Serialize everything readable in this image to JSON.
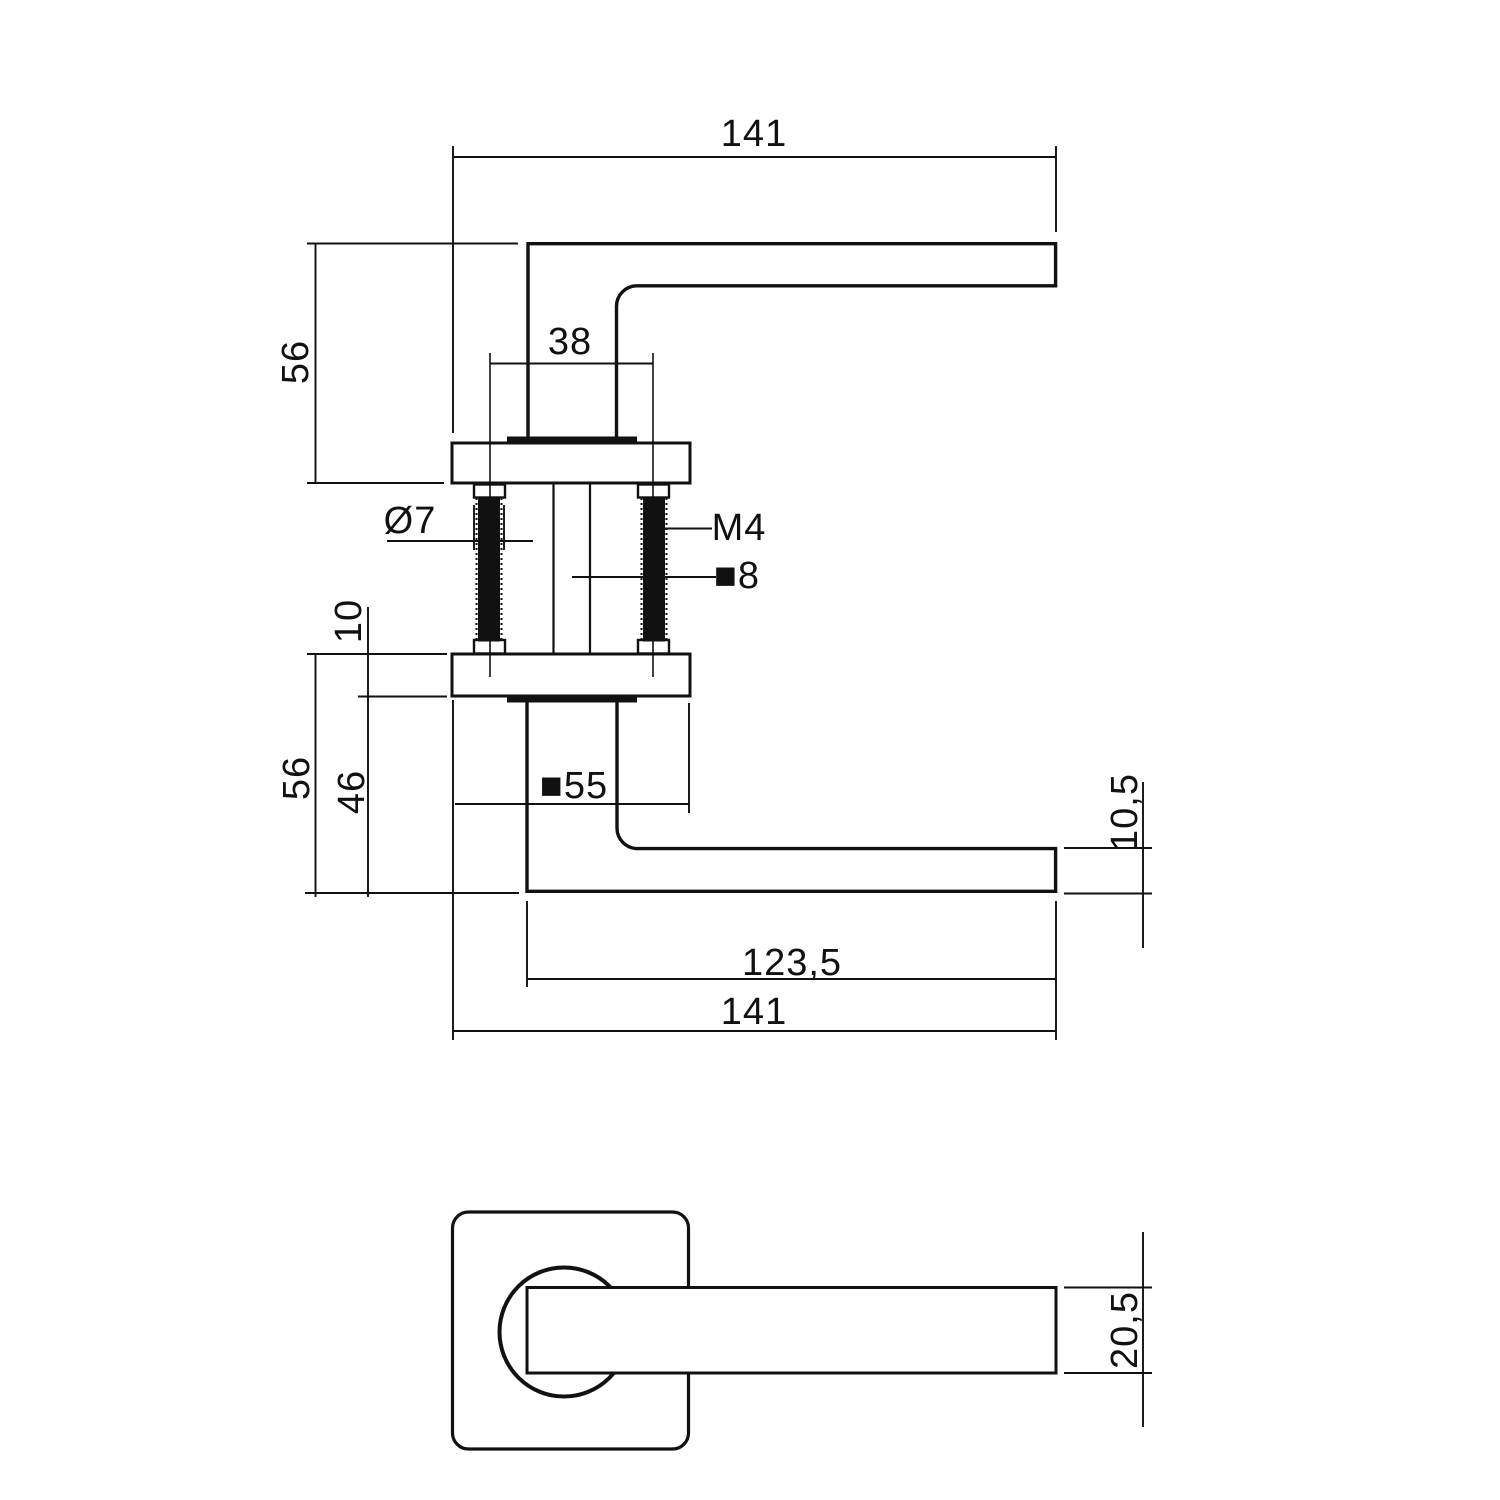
{
  "drawing": {
    "type": "door-handle-dimension-drawing",
    "line_color": "#111111",
    "background_color": "#ffffff",
    "dimensions": {
      "top_total_length": "141",
      "top_overall_height": "56",
      "screw_spacing": "38",
      "hole_diameter": "Ø7",
      "thread_label": "M4",
      "spindle_label": "■8",
      "rose_thickness": "10",
      "bottom_overall_height": "56",
      "rose_to_lever": "46",
      "rose_label": "■55",
      "lever_profile_height": "10,5",
      "lever_arm_length": "123,5",
      "bottom_total_length": "141",
      "lever_width": "20,5"
    }
  }
}
